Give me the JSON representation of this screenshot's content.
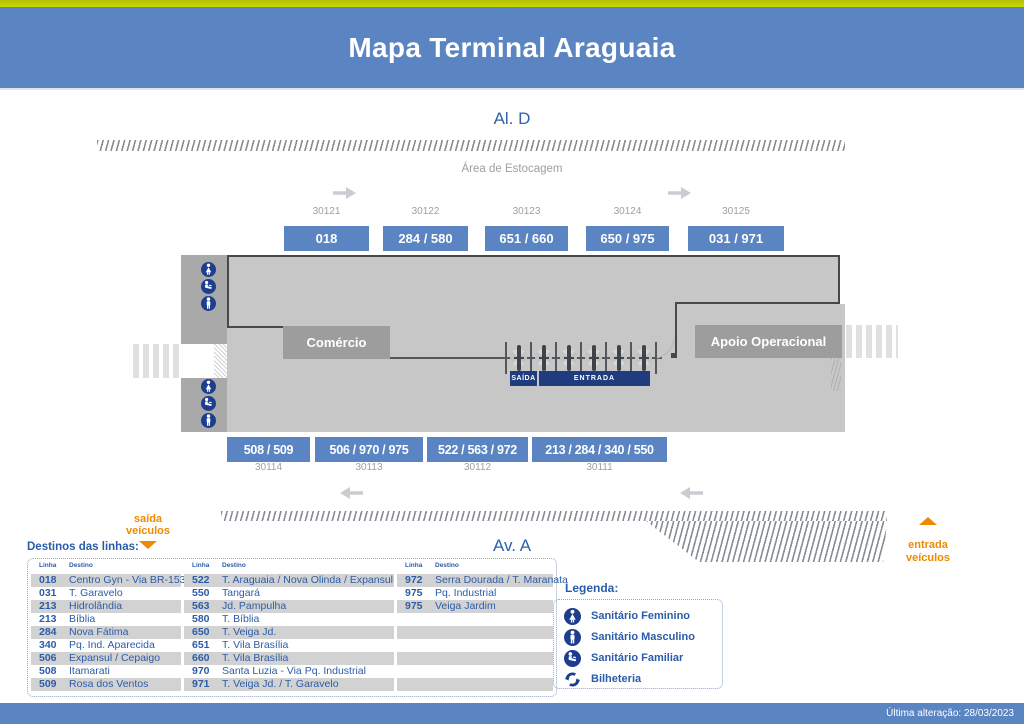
{
  "header": {
    "title": "Mapa Terminal Araguaia"
  },
  "map": {
    "top_street": "Al. D",
    "bottom_street": "Av. A",
    "storage_area_label": "Área de Estocagem",
    "top_platforms": [
      {
        "code": "30121",
        "lines": "018"
      },
      {
        "code": "30122",
        "lines": "284 / 580"
      },
      {
        "code": "30123",
        "lines": "651 / 660"
      },
      {
        "code": "30124",
        "lines": "650 / 975"
      },
      {
        "code": "30125",
        "lines": "031 / 971"
      }
    ],
    "bottom_platforms": [
      {
        "code": "30114",
        "lines": "508 / 509"
      },
      {
        "code": "30113",
        "lines": "506 / 970 / 975"
      },
      {
        "code": "30112",
        "lines": "522 / 563 / 972"
      },
      {
        "code": "30111",
        "lines": "213 / 284 / 340 / 550"
      }
    ],
    "commerce_label": "Comércio",
    "operations_label": "Apoio Operacional",
    "exit_label": "SAÍDA",
    "entrance_label": "ENTRADA",
    "vehicle_exit_label": "saída\nveículos",
    "vehicle_entrance_label": "entrada\nveículos",
    "turnstile_count": 6,
    "restroom_icons_top": [
      "female-restroom-icon",
      "family-restroom-icon",
      "male-restroom-icon"
    ],
    "restroom_icons_bottom": [
      "female-restroom-icon",
      "family-restroom-icon",
      "male-restroom-icon"
    ]
  },
  "destinations": {
    "title": "Destinos das linhas:",
    "col_headers": {
      "line": "Linha",
      "dest": "Destino"
    },
    "columns": [
      {
        "rows": [
          {
            "line": "018",
            "dest": "Centro Gyn - Via BR-153"
          },
          {
            "line": "031",
            "dest": "T. Garavelo"
          },
          {
            "line": "213",
            "dest": "Hidrolândia"
          },
          {
            "line": "213",
            "dest": "Bíblia"
          },
          {
            "line": "284",
            "dest": "Nova Fátima"
          },
          {
            "line": "340",
            "dest": "Pq. Ind. Aparecida"
          },
          {
            "line": "506",
            "dest": "Expansul / Cepaigo"
          },
          {
            "line": "508",
            "dest": "Itamarati"
          },
          {
            "line": "509",
            "dest": "Rosa dos Ventos"
          }
        ]
      },
      {
        "rows": [
          {
            "line": "522",
            "dest": "T. Araguaia / Nova Olinda / Expansul"
          },
          {
            "line": "550",
            "dest": "Tangará"
          },
          {
            "line": "563",
            "dest": "Jd. Pampulha"
          },
          {
            "line": "580",
            "dest": "T. Bíblia"
          },
          {
            "line": "650",
            "dest": "T. Veiga Jd."
          },
          {
            "line": "651",
            "dest": "T. Vila Brasília"
          },
          {
            "line": "660",
            "dest": "T. Vila Brasília"
          },
          {
            "line": "970",
            "dest": "Santa Luzia - Via Pq. Industrial"
          },
          {
            "line": "971",
            "dest": "T. Veiga Jd. / T. Garavelo"
          }
        ]
      },
      {
        "rows": [
          {
            "line": "972",
            "dest": "Serra Dourada / T. Maranata"
          },
          {
            "line": "975",
            "dest": "Pq. Industrial"
          },
          {
            "line": "975",
            "dest": "Veiga Jardim"
          },
          {
            "line": "",
            "dest": ""
          },
          {
            "line": "",
            "dest": ""
          },
          {
            "line": "",
            "dest": ""
          },
          {
            "line": "",
            "dest": ""
          },
          {
            "line": "",
            "dest": ""
          },
          {
            "line": "",
            "dest": ""
          }
        ]
      }
    ]
  },
  "legend": {
    "title": "Legenda:",
    "items": [
      {
        "icon": "female-restroom-icon",
        "label": "Sanitário Feminino"
      },
      {
        "icon": "male-restroom-icon",
        "label": "Sanitário Masculino"
      },
      {
        "icon": "family-restroom-icon",
        "label": "Sanitário Familiar"
      },
      {
        "icon": "ticket-office-icon",
        "label": "Bilheteria"
      }
    ]
  },
  "footer": {
    "last_update": "Última alteração: 28/03/2023"
  },
  "colors": {
    "accent_yellow": "#c0cc03",
    "header_blue": "#5b84c3",
    "badge_blue": "#5b84c3",
    "text_blue": "#2b5ca8",
    "navy": "#1e3c7e",
    "icon_blue": "#1d3e8e",
    "orange": "#ee8a00",
    "terminal_gray": "#c7c7c7",
    "strip_gray": "#a9a9a9",
    "box_gray": "#9d9d9d",
    "shaded_row": "#d2d2d2"
  }
}
